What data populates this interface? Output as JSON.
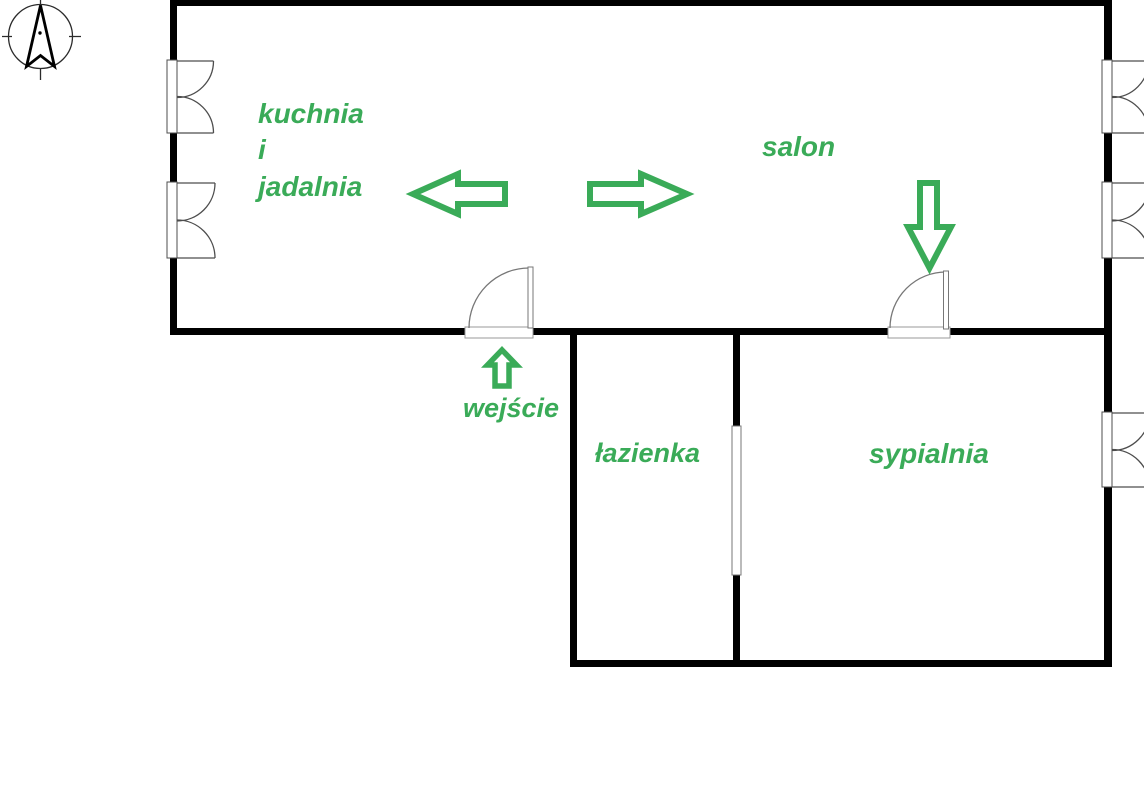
{
  "floor_plan": {
    "rooms": [
      {
        "id": "kuchnia-i-jadalnia",
        "lines": [
          "kuchnia",
          "i",
          "jadalnia"
        ]
      },
      {
        "id": "salon",
        "label": "salon"
      },
      {
        "id": "lazienka",
        "label": "łazienka"
      },
      {
        "id": "sypialnia",
        "label": "sypialnia"
      }
    ],
    "entrance_label": "wejście",
    "annotations": {
      "arrow_icons": [
        "left-arrow-icon",
        "right-arrow-icon",
        "down-arrow-icon",
        "up-arrow-icon"
      ],
      "compass": "north-compass-icon"
    },
    "colors": {
      "annotation_green": "#3aab58",
      "wall_black": "#000000",
      "door_outline": "#777777",
      "window_outline": "#4d4d4d"
    }
  }
}
